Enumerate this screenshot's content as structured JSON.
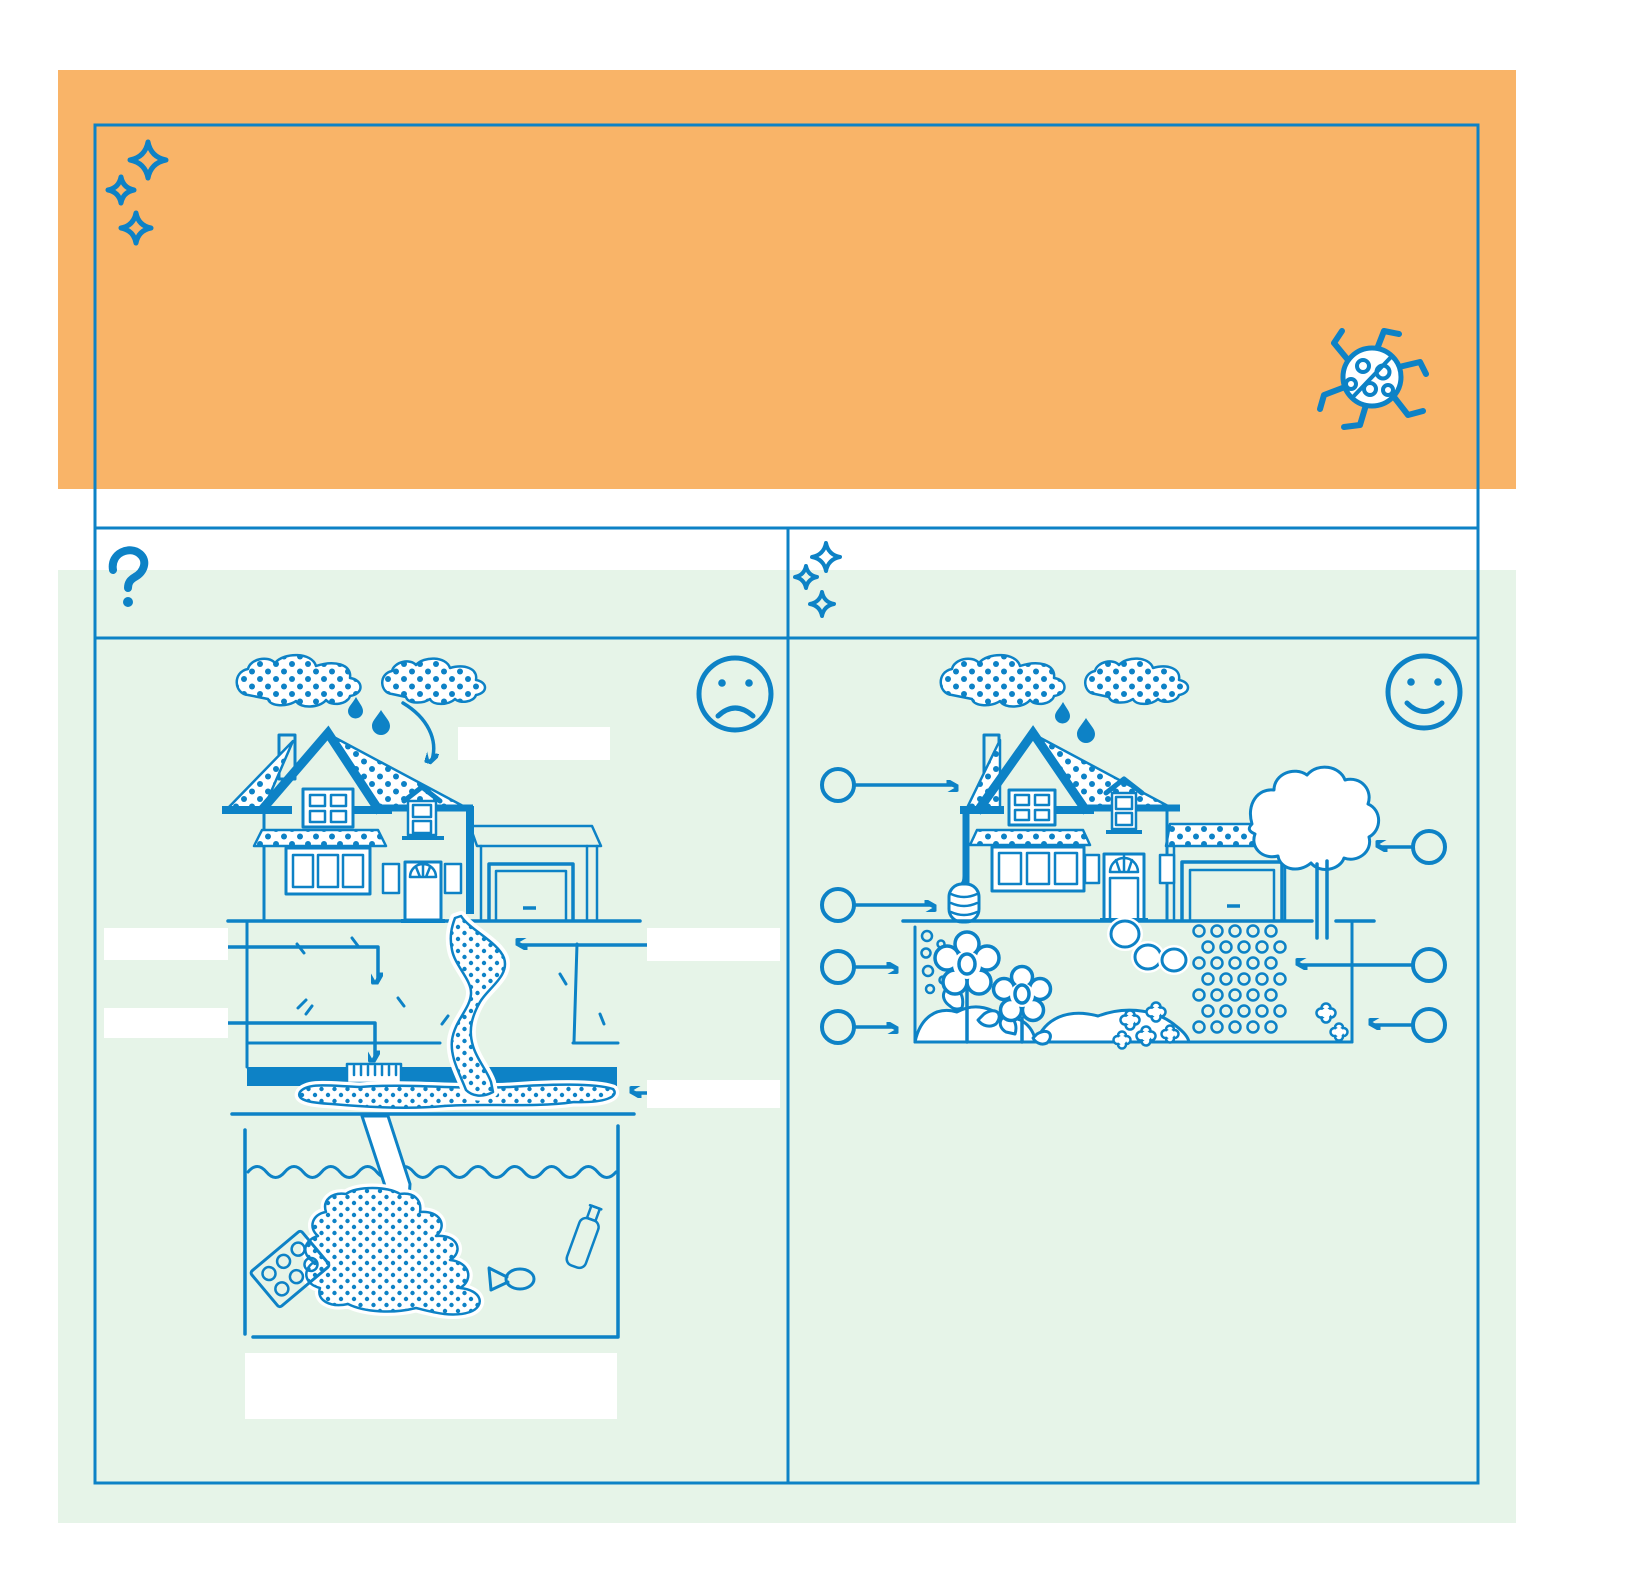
{
  "colors": {
    "ink": "#0D82C6",
    "orange": "#F9B468",
    "green": "#E6F4E8"
  },
  "banner": {
    "text": "",
    "icons": [
      "sparkles-icon",
      "ladybug-icon"
    ]
  },
  "header_row": {
    "left": {
      "icon": "question-mark-icon",
      "text": ""
    },
    "right": {
      "icon": "sparkles-icon",
      "text": ""
    }
  },
  "left_panel": {
    "mood_icon": "sad-face-icon",
    "scene": "house-with-stormwater-runoff-to-storm-drain-and-polluted-waterway",
    "scene_elements": [
      "rain-clouds",
      "rain-drops",
      "arrow-to-roof",
      "house",
      "garage",
      "downspout-runoff-stream",
      "soil-cross-section",
      "storm-drain-grate",
      "street",
      "outflow-pipe",
      "pollution-plume",
      "six-pack-rings",
      "fish",
      "plastic-bottle"
    ],
    "label_placeholders": [
      "",
      "",
      "",
      "",
      "",
      ""
    ]
  },
  "right_panel": {
    "mood_icon": "happy-face-icon",
    "scene": "house-with-green-infrastructure",
    "scene_elements": [
      "rain-clouds",
      "rain-drops",
      "house",
      "garage",
      "rain-barrel",
      "tree",
      "rain-garden-flowers",
      "infiltration-dots",
      "stepping-stones",
      "permeable-pavers",
      "ground-cover-flowers"
    ],
    "callouts": {
      "left_count": 4,
      "right_count": 3,
      "labels": [
        "",
        "",
        "",
        "",
        "",
        "",
        ""
      ]
    }
  }
}
